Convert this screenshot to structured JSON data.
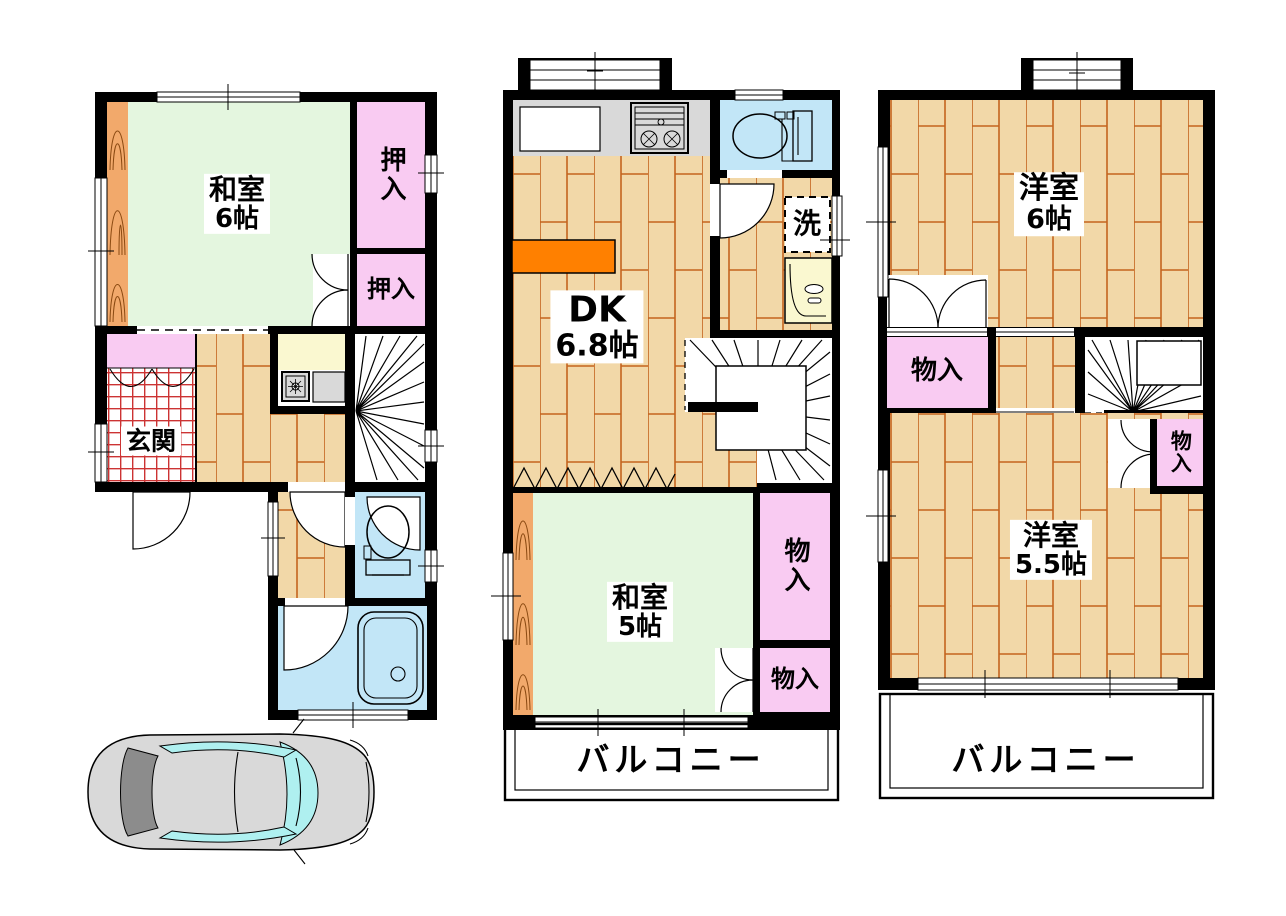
{
  "floor1": {
    "washitsu": {
      "name": "和室",
      "size": "6帖"
    },
    "oshiire_upper": "押入",
    "oshiire_lower": "押入",
    "genkan": "玄関"
  },
  "floor2": {
    "dk": {
      "name": "DK",
      "size": "6.8帖"
    },
    "laundry": "洗",
    "washitsu": {
      "name": "和室",
      "size": "5帖"
    },
    "monoire_upper": "物入",
    "monoire_lower": "物入",
    "balcony": "バルコニー"
  },
  "floor3": {
    "youshitsu_large": {
      "name": "洋室",
      "size": "6帖"
    },
    "monoire_left": "物入",
    "monoire_right": "物入",
    "youshitsu_small": {
      "name": "洋室",
      "size": "5.5帖"
    },
    "balcony": "バルコニー"
  },
  "colors": {
    "wall": "#000000",
    "wood_floor": "#F2D8A8",
    "wood_line": "#C4641E",
    "tatami_green": "#E4F6DF",
    "closet_pink": "#F9CBF2",
    "water_blue": "#C2E6F7",
    "counter_gray": "#D9D9D9",
    "counter_yellow": "#FAF8D0",
    "accent_orange": "#FF8000",
    "grain_wood": "#F2A96B",
    "genkan_grid_red": "#CC3333",
    "car_body": "#D9D9D9",
    "car_glass": "#AFF0F0",
    "car_rear_glass": "#8C8C8C"
  }
}
